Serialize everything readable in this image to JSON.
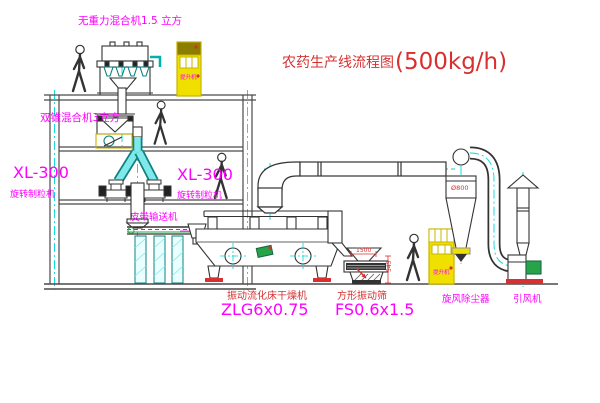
{
  "diagram": {
    "title": "农药生产线流程图",
    "capacity": "(500kg/h)"
  },
  "labels": {
    "gravity_mixer": "无重力混合机1.5 立方",
    "cone_mixer": "双锥混合机3立方",
    "granulator_model_left": "XL-300",
    "granulator_name_left": "旋转制粒机",
    "granulator_model_mid": "XL-300",
    "granulator_name_mid": "旋转制粒机",
    "belt_conveyor": "皮带输送机",
    "dryer_name": "振动流化床干燥机",
    "dryer_model": "ZLG6x0.75",
    "sieve_name": "方形振动筛",
    "sieve_model": "FS0.6x1.5",
    "cyclone": "旋风除尘器",
    "fan": "引风机",
    "elevator_top": "提升机",
    "elevator_right": "提升机"
  },
  "dimensions": {
    "cyclone_diameter": "Ø800",
    "sieve_width": "1500",
    "sieve_height": "545"
  },
  "colors": {
    "label_magenta": "#ff00ff",
    "annotation_red": "#d83030",
    "machine_yellow": "#f0e000",
    "centerline_cyan": "#00d8d8",
    "motor_green": "#27a34a",
    "line_dark": "#3b3b3b"
  }
}
